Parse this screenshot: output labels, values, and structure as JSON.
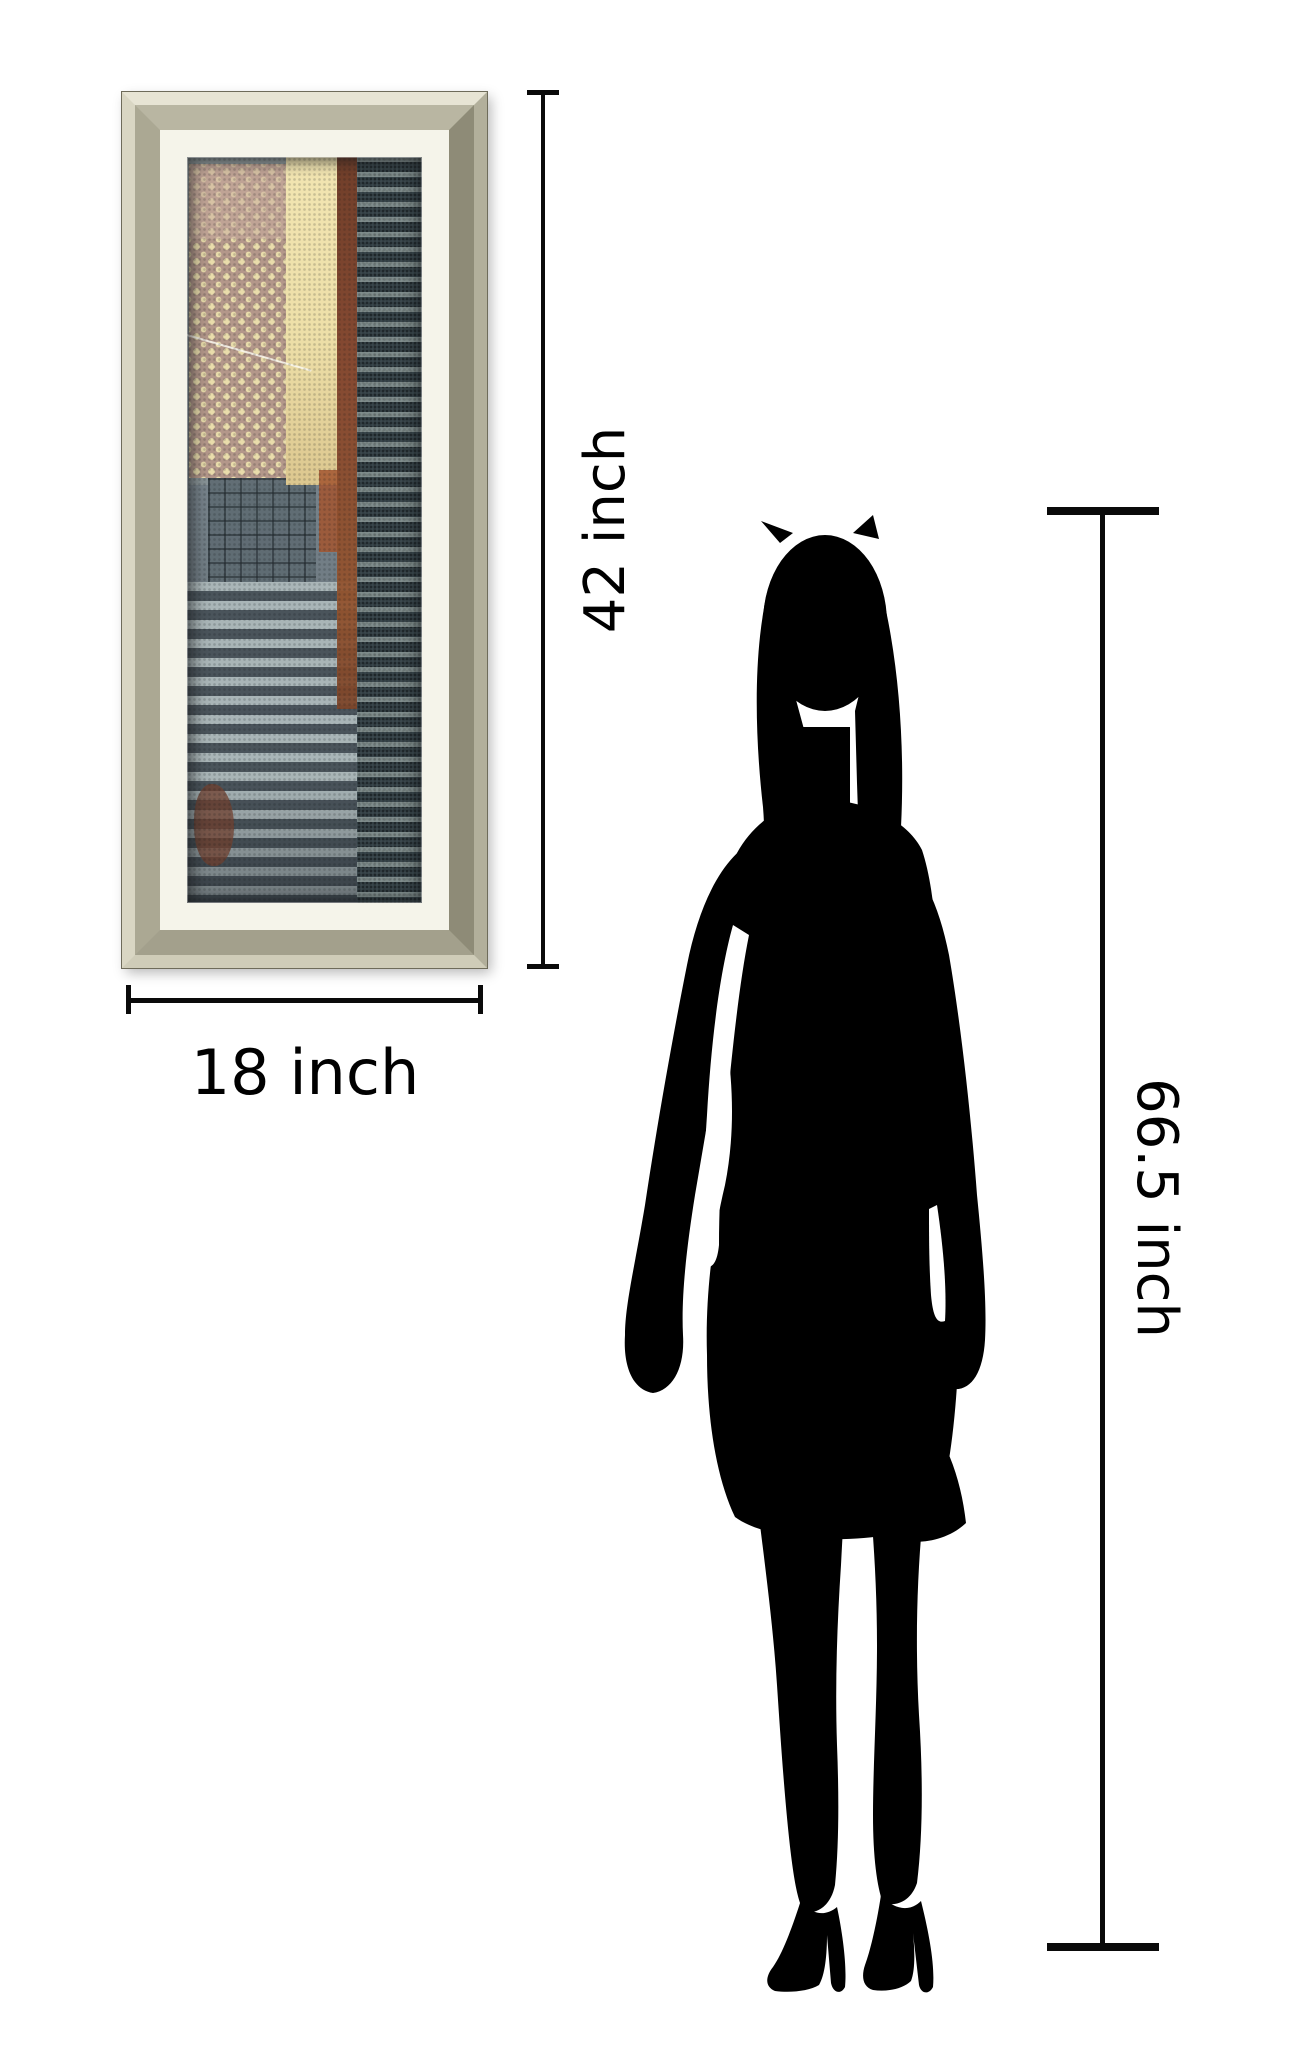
{
  "page": {
    "background_hex": "#ffffff"
  },
  "product": {
    "type": "framed-wall-art-print",
    "frame_style": "champagne-silver-beveled-frame",
    "art_description": "abstract-cityscape-collage-panel"
  },
  "dimensions": {
    "frame_height_label": "42 inch",
    "frame_width_label": "18 inch",
    "person_height_label": "66.5 inch"
  },
  "figure": {
    "type": "standing-woman-silhouette",
    "color_hex": "#000000"
  },
  "palette": {
    "page-bg": "#ffffff",
    "dimension-line": "#0a0a0a",
    "label-text": "#000000",
    "silhouette": "#000000",
    "frame-liner": "#f5f4ea",
    "art-base-top": "#929c9d",
    "art-base-bottom": "#5d686f",
    "art-dot-block": "#b3978a",
    "art-dot": "#e9dcab",
    "art-cream": "#eddfa8",
    "art-rust": "#84452c",
    "art-teal-dark": "#3a474c",
    "art-stripe-light": "#a9b5b7",
    "art-stripe-dark": "#4a545b"
  }
}
